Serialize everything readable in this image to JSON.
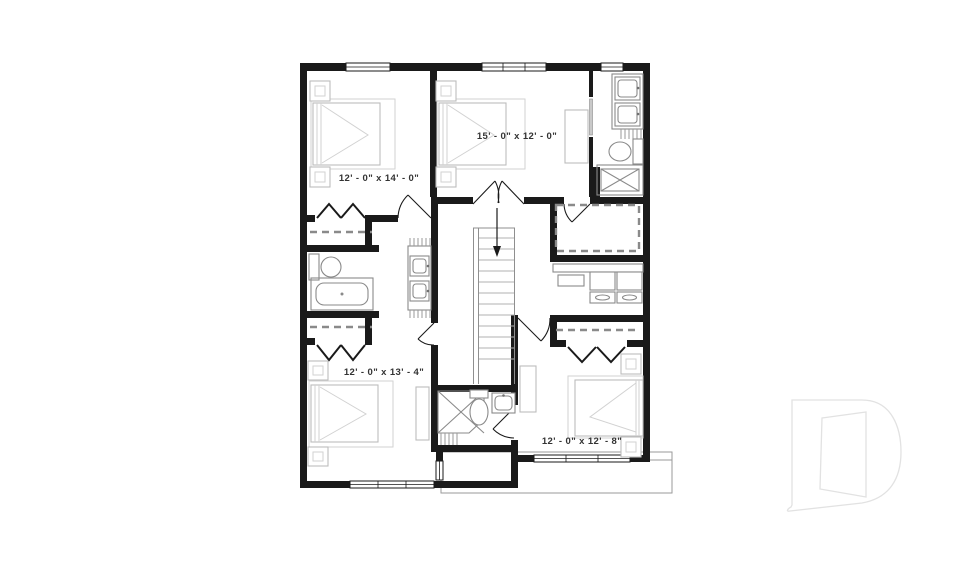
{
  "page": {
    "background": "#ffffff"
  },
  "plan": {
    "title": "second-floor-plan",
    "rooms": [
      {
        "name": "bedroom-1",
        "label": "12' - 0\" x 14' - 0\""
      },
      {
        "name": "bedroom-2",
        "label": "15' - 0\" x 12' - 0\""
      },
      {
        "name": "bedroom-3",
        "label": "12' - 0\" x 13' - 4\""
      },
      {
        "name": "bedroom-4",
        "label": "12' - 0\" x 12' - 8\""
      }
    ],
    "features": {
      "stairs": "down",
      "closets": [
        "walk-in-closet",
        "bedroom-1-closet",
        "bedroom-3-closet",
        "bedroom-4-closet"
      ],
      "bathrooms": [
        "ensuite-bathroom",
        "shared-bathroom",
        "hall-bathroom"
      ],
      "laundry": "washer-dryer"
    },
    "colors": {
      "wall": "#1a1a1a",
      "furniture": "#bdbdbd",
      "fixture": "#8a8a8a",
      "dashed": "#8a8a8a",
      "label": "#333333",
      "porch_outline": "#9a9a9a",
      "watermark": "#e2e2e2"
    }
  },
  "watermark": {
    "name": "builder-logo-d"
  }
}
